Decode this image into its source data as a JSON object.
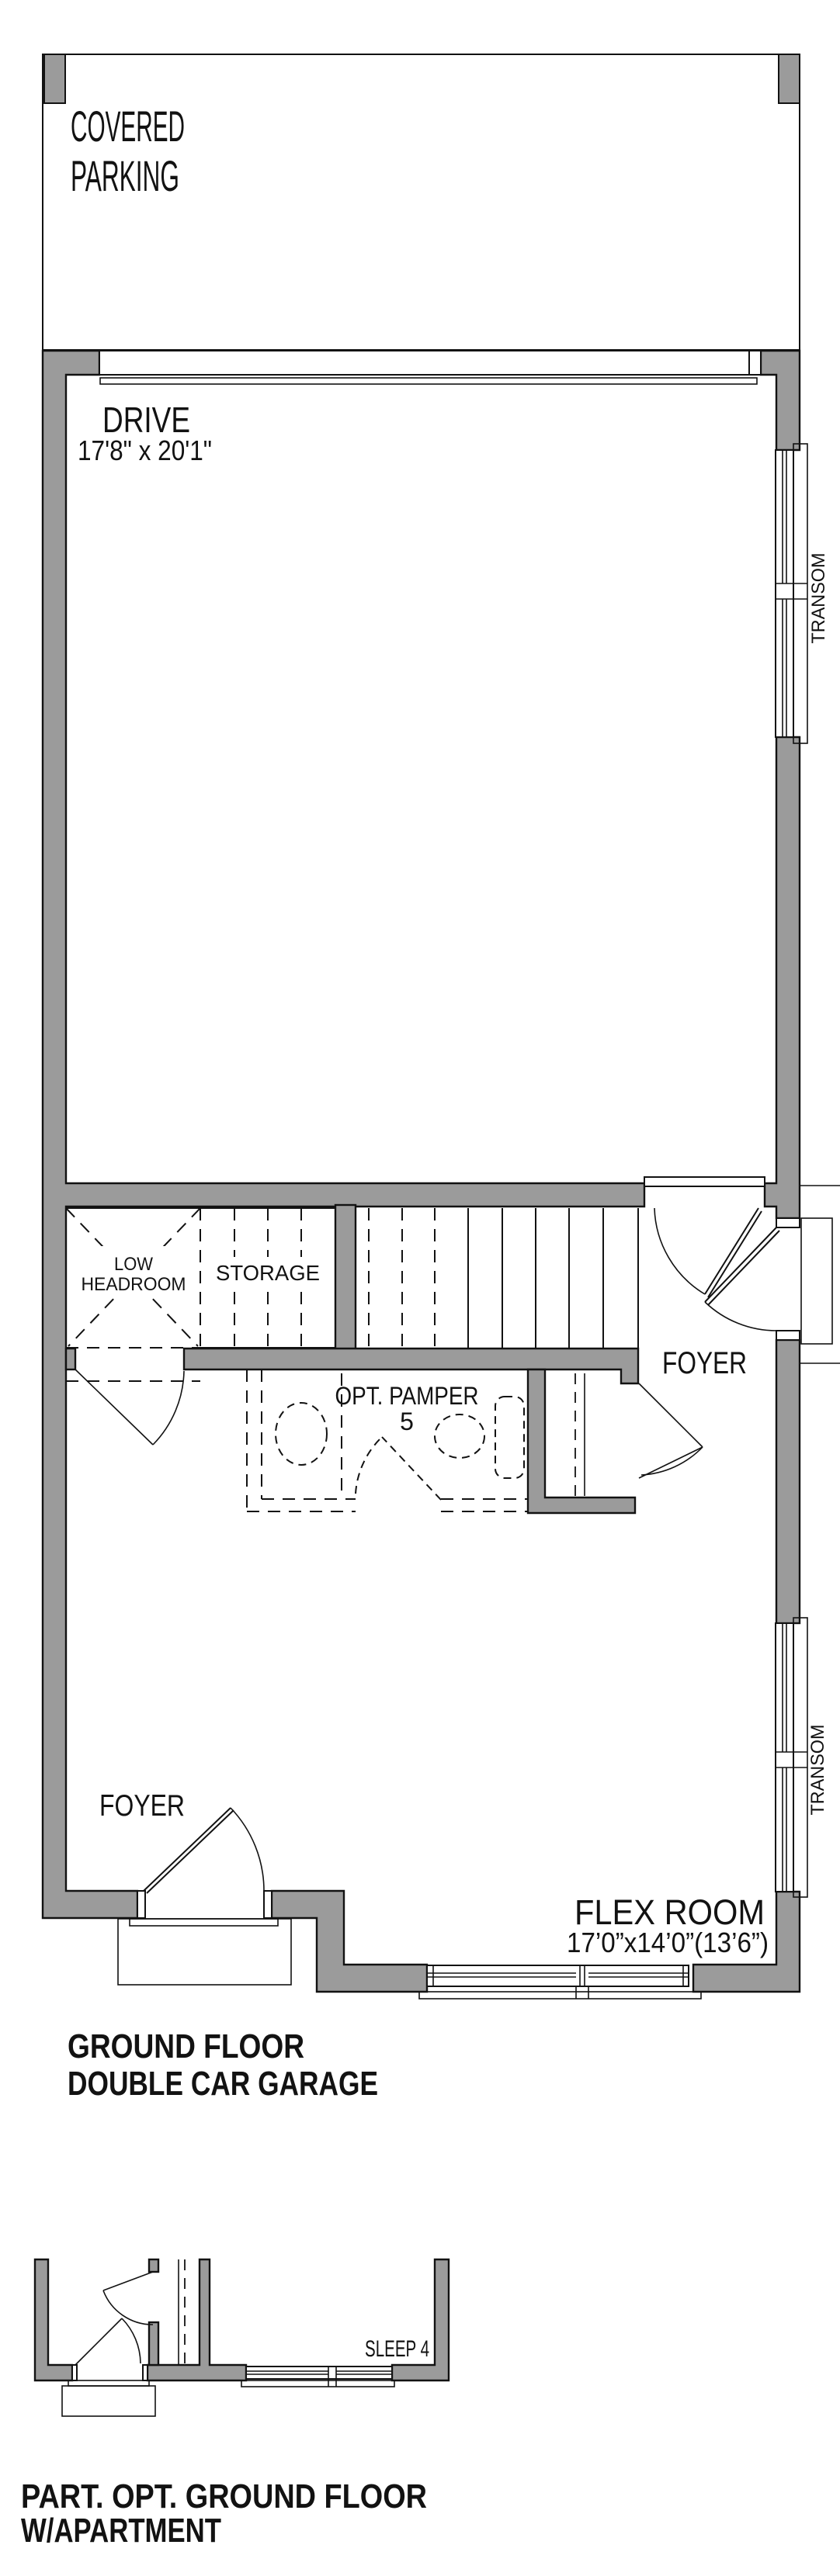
{
  "colors": {
    "wall_fill": "#9b9b9b",
    "line": "#121212",
    "background": "#ffffff"
  },
  "main_plan": {
    "rooms": {
      "covered_parking": {
        "label_line1": "COVERED",
        "label_line2": "PARKING"
      },
      "drive": {
        "label": "DRIVE",
        "dimensions": "17'8\" x 20'1\""
      },
      "low_headroom": {
        "label_line1": "LOW",
        "label_line2": "HEADROOM"
      },
      "storage": {
        "label": "STORAGE"
      },
      "opt_pamper": {
        "label_line1": "OPT. PAMPER",
        "label_line2": "5"
      },
      "foyer_upper": {
        "label": "FOYER"
      },
      "foyer_lower": {
        "label": "FOYER"
      },
      "flex_room": {
        "label": "FLEX ROOM",
        "dimensions": "17’0”x14’0”(13’6”)"
      }
    },
    "windows": {
      "transom_upper": {
        "label": "TRANSOM"
      },
      "transom_lower": {
        "label": "TRANSOM"
      }
    },
    "caption_line1": "GROUND FLOOR",
    "caption_line2": "DOUBLE CAR GARAGE"
  },
  "apartment_plan": {
    "rooms": {
      "sleep4": {
        "label": "SLEEP 4"
      }
    },
    "caption_line1": "PART. OPT. GROUND FLOOR",
    "caption_line2": "W/APARTMENT"
  }
}
